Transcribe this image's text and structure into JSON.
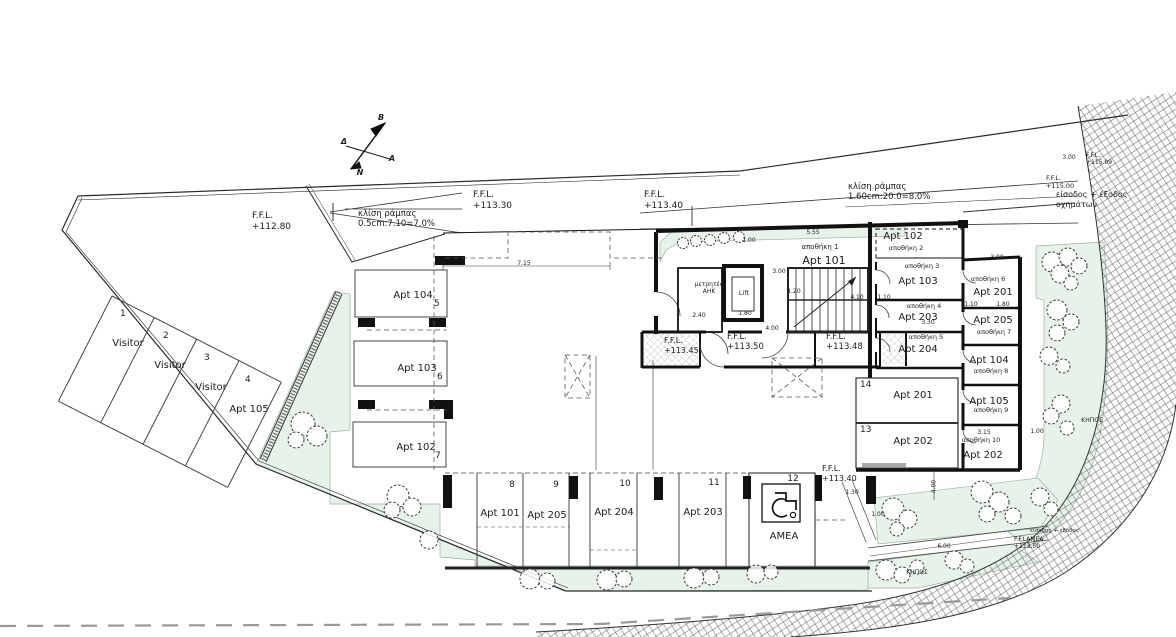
{
  "compass": {
    "north": "B",
    "west": "Δ",
    "east": "A",
    "south": "N"
  },
  "ramp_notes": {
    "west": {
      "l1": "κλίση ράμπας",
      "l2": "0.5cm:7.10=7.0%"
    },
    "main": {
      "l1": "κλίση ράμπας",
      "l2": "1.60cm:20.0=8.0%"
    }
  },
  "levels": {
    "site": {
      "l1": "F.F.L.",
      "l2": "+112.80"
    },
    "garage_w": {
      "l1": "F.F.L.",
      "l2": "+113.30"
    },
    "garage_e": {
      "l1": "F.F.L.",
      "l2": "+113.40"
    },
    "street_hi": {
      "l1": "F.F.L.",
      "l2": "+115.09"
    },
    "street": {
      "l1": "F.F.L.",
      "l2": "+115.00"
    },
    "lobby_w": {
      "l1": "F.F.L.",
      "l2": "+113.45"
    },
    "lobby": {
      "l1": "F.F.L.",
      "l2": "+113.50"
    },
    "lobby_e": {
      "l1": "F.F.L.",
      "l2": "+113.48"
    },
    "amea": {
      "l1": "F.F.L.",
      "l2": "+113.40"
    },
    "ramp_amea": {
      "l1": "F.F.LAMEA",
      "l2": "+113.50"
    }
  },
  "entries": {
    "vehicle": {
      "l1": "είσοδος + έξοδος",
      "l2": "οχημάτων"
    },
    "pedestrian": "είσοδος + έξοδος"
  },
  "rooms": {
    "lift": "Lift",
    "meters": {
      "l1": "μετρητές",
      "l2": "ΑΗΚ"
    },
    "store1": {
      "store": "αποθήκη 1",
      "apt": "Apt 101"
    }
  },
  "stores_left": [
    {
      "apt": "Apt 102",
      "store": "αποθήκη 2"
    },
    {
      "apt": "Apt 103",
      "store": "αποθήκη 3"
    },
    {
      "apt": "Apt 203",
      "store": "αποθήκη 4"
    },
    {
      "apt": "Apt 204",
      "store": "αποθήκη 5"
    }
  ],
  "stores_right": [
    {
      "apt": "Apt 201",
      "store": "αποθήκη 6"
    },
    {
      "apt": "Apt 205",
      "store": "αποθήκη 7"
    },
    {
      "apt": "Apt 104",
      "store": "αποθήκη 8"
    },
    {
      "apt": "Apt 105",
      "store": "αποθήκη 9"
    },
    {
      "apt": "Apt 202",
      "store": "αποθήκη 10"
    }
  ],
  "visitor_stalls": [
    {
      "num": "1",
      "label": "Visitor"
    },
    {
      "num": "2",
      "label": "Visitor"
    },
    {
      "num": "3",
      "label": "Visitor"
    },
    {
      "num": "4",
      "label": "Apt 105"
    }
  ],
  "west_stalls": [
    {
      "num": "5",
      "label": "Apt 104"
    },
    {
      "num": "6",
      "label": "Apt 103"
    },
    {
      "num": "7",
      "label": "Apt 102"
    }
  ],
  "south_stalls": [
    {
      "num": "8",
      "label": "Apt 101"
    },
    {
      "num": "9",
      "label": "Apt 205"
    },
    {
      "num": "10",
      "label": "Apt 204"
    },
    {
      "num": "11",
      "label": "Apt 203"
    },
    {
      "num": "12",
      "label": "AMEA"
    }
  ],
  "east_stalls": [
    {
      "num": "14",
      "label": "Apt 201"
    },
    {
      "num": "13",
      "label": "Apt 202"
    }
  ],
  "garden_label": "ΚΗΠΟΣ",
  "dims": {
    "d715": "7.15",
    "d555": "5.55",
    "d100a": "1.00",
    "d300a": "3.00",
    "d120": "1.20",
    "d180a": "1.80",
    "d240": "2.40",
    "d400a": "4.00",
    "d410": "4.10",
    "d110a": "1.10",
    "d300b": "3.00",
    "d110b": "1.10",
    "d180b": "1.80",
    "d330": "3.30",
    "d315": "3.15",
    "d100b": "1.00",
    "d130": "1.30",
    "d100c": "1.00",
    "d400b": "4.00",
    "d600": "6.00",
    "d300c": "3.00"
  },
  "colors": {
    "garden_green": "#e7f3e9",
    "line": "#1c1c1c",
    "boundary_dash": "#999999"
  }
}
